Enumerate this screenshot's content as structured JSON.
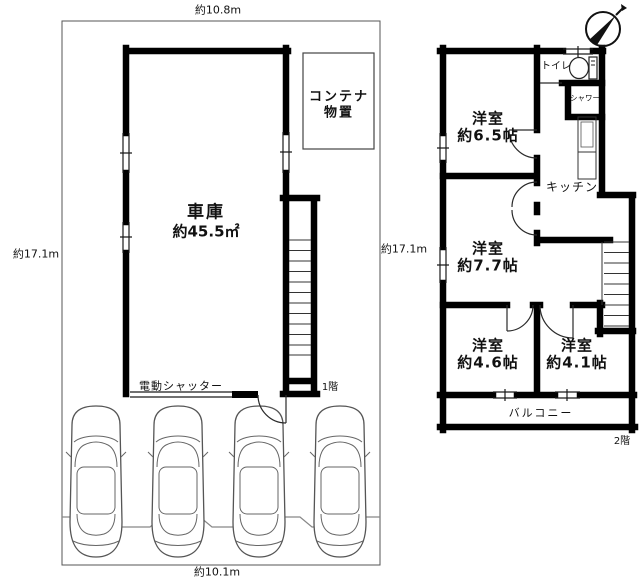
{
  "first_floor": {
    "dim_top": "約10.8m",
    "dim_left": "約17.1m",
    "dim_bottom": "約10.1m",
    "floor_label": "1階",
    "garage": {
      "name": "車庫",
      "area": "約45.5㎡"
    },
    "container_storage": {
      "line1": "コンテナ",
      "line2": "物置"
    },
    "shutter_label": "電動シャッター",
    "car_count": 4
  },
  "second_floor": {
    "dim_left": "約17.1m",
    "floor_label": "2階",
    "rooms": [
      {
        "name": "洋室",
        "size": "約6.5帖"
      },
      {
        "name": "洋室",
        "size": "約7.7帖"
      },
      {
        "name": "洋室",
        "size": "約4.6帖"
      },
      {
        "name": "洋室",
        "size": "約4.1帖"
      }
    ],
    "toilet_label": "トイレ",
    "shower_label": "シャワー",
    "kitchen_label": "キッチン",
    "balcony_label": "バルコニー"
  },
  "icons": {
    "compass": "north-arrow-compass-icon",
    "toilet": "toilet-fixture-icon",
    "car": "car-top-view-icon",
    "stairs": "staircase-icon"
  },
  "colors": {
    "wall": "#000000",
    "thin_line": "#2a2a2a",
    "boundary": "#555555",
    "car_outline": "#555555",
    "fence": "#888888",
    "background": "#ffffff",
    "text": "#111111"
  }
}
